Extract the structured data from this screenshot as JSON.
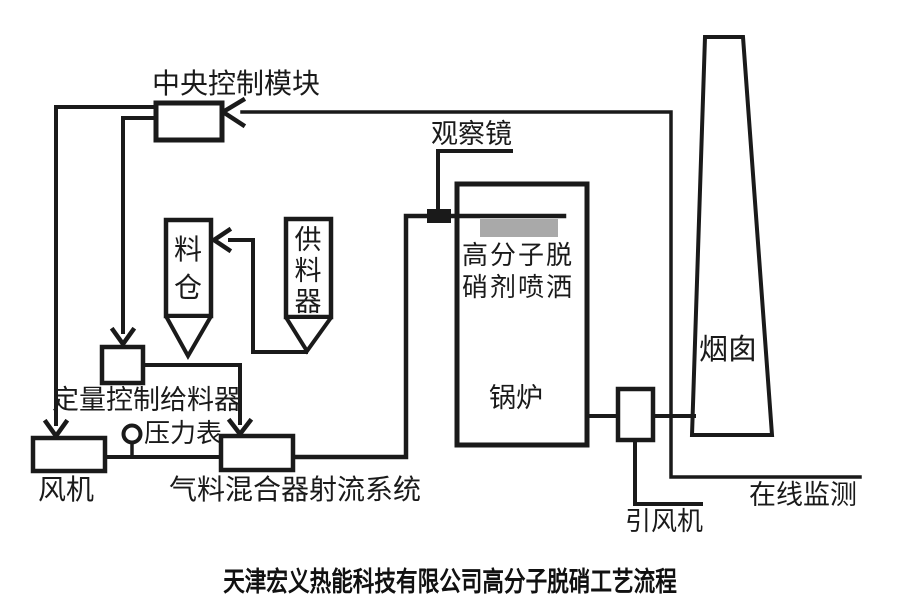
{
  "diagram": {
    "caption": "天津宏义热能科技有限公司高分子脱硝工艺流程",
    "labels": {
      "central_control": "中央控制模块",
      "observation_mirror": "观察镜",
      "material_bin": "料仓",
      "feeder": "供料器",
      "quantitative_feeder": "定量控制给料器",
      "pressure_gauge": "压力表",
      "fan": "风机",
      "gas_material_jet_mixer": "气料混合器射流系统",
      "boiler": "锅炉",
      "spray_label_line1": "高分子脱",
      "spray_label_line2": "硝剂喷洒",
      "chimney": "烟囱",
      "induced_draft_fan": "引风机",
      "online_monitoring": "在线监测"
    },
    "colors": {
      "line": "#1a1a1a",
      "background": "#ffffff",
      "spray_zone": "#a9a9a9"
    },
    "connections": [
      "中央控制模块 → 风机",
      "中央控制模块 → 定量控制给料器",
      "供料器 → 料仓",
      "定量控制给料器 → 气料混合器射流系统",
      "风机 → 气料混合器射流系统",
      "气料混合器射流系统 → 锅炉 高分子脱硝剂喷洒",
      "锅炉 → 引风机 → 烟囱",
      "在线监测 → 中央控制模块"
    ]
  }
}
